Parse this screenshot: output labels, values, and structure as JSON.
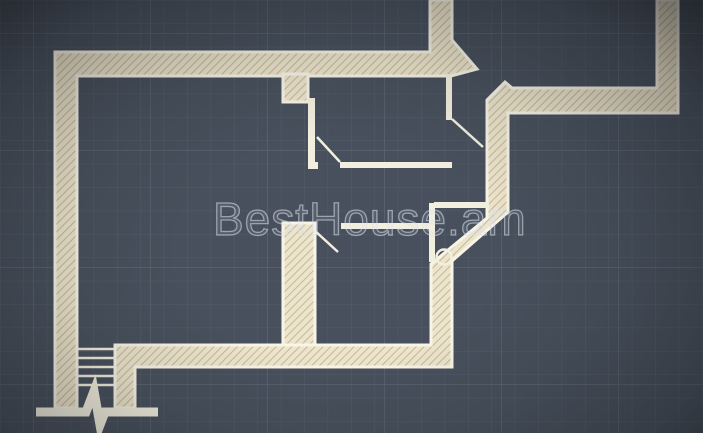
{
  "watermark": {
    "text": "BestHouse.am"
  },
  "canvas": {
    "width": 703,
    "height": 433
  },
  "colors": {
    "background": "#47505c",
    "grid_minor": "rgba(190,205,225,0.10)",
    "grid_major": "rgba(200,215,235,0.15)",
    "wall_fill": "#ece4cb",
    "wall_hatch": "#bfb394",
    "wall_edge": "#f8f4e6",
    "thin_wall": "#f3efdf",
    "watermark": "#dbe1ec"
  },
  "plan": {
    "grid": {
      "minor_step": 23.4,
      "major_step": 117
    },
    "hatched_walls": [
      {
        "name": "exterior-wall-top-left",
        "points": [
          [
            55,
            52
          ],
          [
            430,
            52
          ],
          [
            430,
            0
          ],
          [
            452,
            0
          ],
          [
            452,
            40
          ],
          [
            477,
            69
          ],
          [
            451,
            76
          ],
          [
            77,
            76
          ],
          [
            77,
            408
          ],
          [
            55,
            408
          ]
        ]
      },
      {
        "name": "entry-stub-wall",
        "points": [
          [
            283,
            74
          ],
          [
            308,
            74
          ],
          [
            308,
            102
          ],
          [
            283,
            102
          ]
        ]
      },
      {
        "name": "exterior-wall-right-and-bottom",
        "points": [
          [
            505,
            82
          ],
          [
            512,
            88
          ],
          [
            657,
            88
          ],
          [
            657,
            0
          ],
          [
            678,
            0
          ],
          [
            678,
            113
          ],
          [
            508,
            113
          ],
          [
            508,
            212
          ],
          [
            452,
            261
          ],
          [
            452,
            367
          ],
          [
            135,
            367
          ],
          [
            135,
            408
          ],
          [
            115,
            408
          ],
          [
            115,
            345
          ],
          [
            431,
            345
          ],
          [
            431,
            264
          ],
          [
            487,
            218
          ],
          [
            487,
            100
          ]
        ]
      },
      {
        "name": "interior-bearing-wall",
        "points": [
          [
            283,
            223
          ],
          [
            315,
            223
          ],
          [
            315,
            345
          ],
          [
            283,
            345
          ]
        ]
      }
    ],
    "thin_walls": [
      {
        "name": "bedroom-left-partition",
        "x": 308,
        "y": 98,
        "w": 7,
        "h": 66
      },
      {
        "name": "bedroom-corner-stub",
        "x": 308,
        "y": 162,
        "w": 10,
        "h": 7
      },
      {
        "name": "bedroom-bottom-partition",
        "x": 340,
        "y": 162,
        "w": 112,
        "h": 6
      },
      {
        "name": "bedroom-right-partition",
        "x": 446,
        "y": 74,
        "w": 6,
        "h": 46
      },
      {
        "name": "hallway-partition",
        "x": 341,
        "y": 223,
        "w": 90,
        "h": 6
      },
      {
        "name": "shaft-partition-vertical",
        "x": 429,
        "y": 203,
        "w": 6,
        "h": 59
      },
      {
        "name": "shaft-partition-horizontal",
        "x": 434,
        "y": 202,
        "w": 55,
        "h": 6
      }
    ],
    "door_swings": [
      {
        "name": "door-swing-bedroom",
        "x1": 340,
        "y1": 162,
        "x2": 317,
        "y2": 137
      },
      {
        "name": "door-swing-entry",
        "x1": 452,
        "y1": 119,
        "x2": 483,
        "y2": 147
      },
      {
        "name": "door-swing-hallway",
        "x1": 314,
        "y1": 230,
        "x2": 338,
        "y2": 252
      }
    ],
    "stairs": {
      "x1": 78,
      "x2": 114,
      "ys": [
        349,
        358,
        367,
        376,
        385
      ]
    },
    "break_bar": {
      "points": [
        [
          36,
          412
        ],
        [
          86,
          412
        ],
        [
          94,
          391
        ],
        [
          100,
          425
        ],
        [
          105,
          412
        ],
        [
          158,
          412
        ]
      ],
      "thickness": 9
    },
    "fixture_circle": {
      "cx": 444,
      "cy": 257,
      "r": 7.5
    }
  }
}
